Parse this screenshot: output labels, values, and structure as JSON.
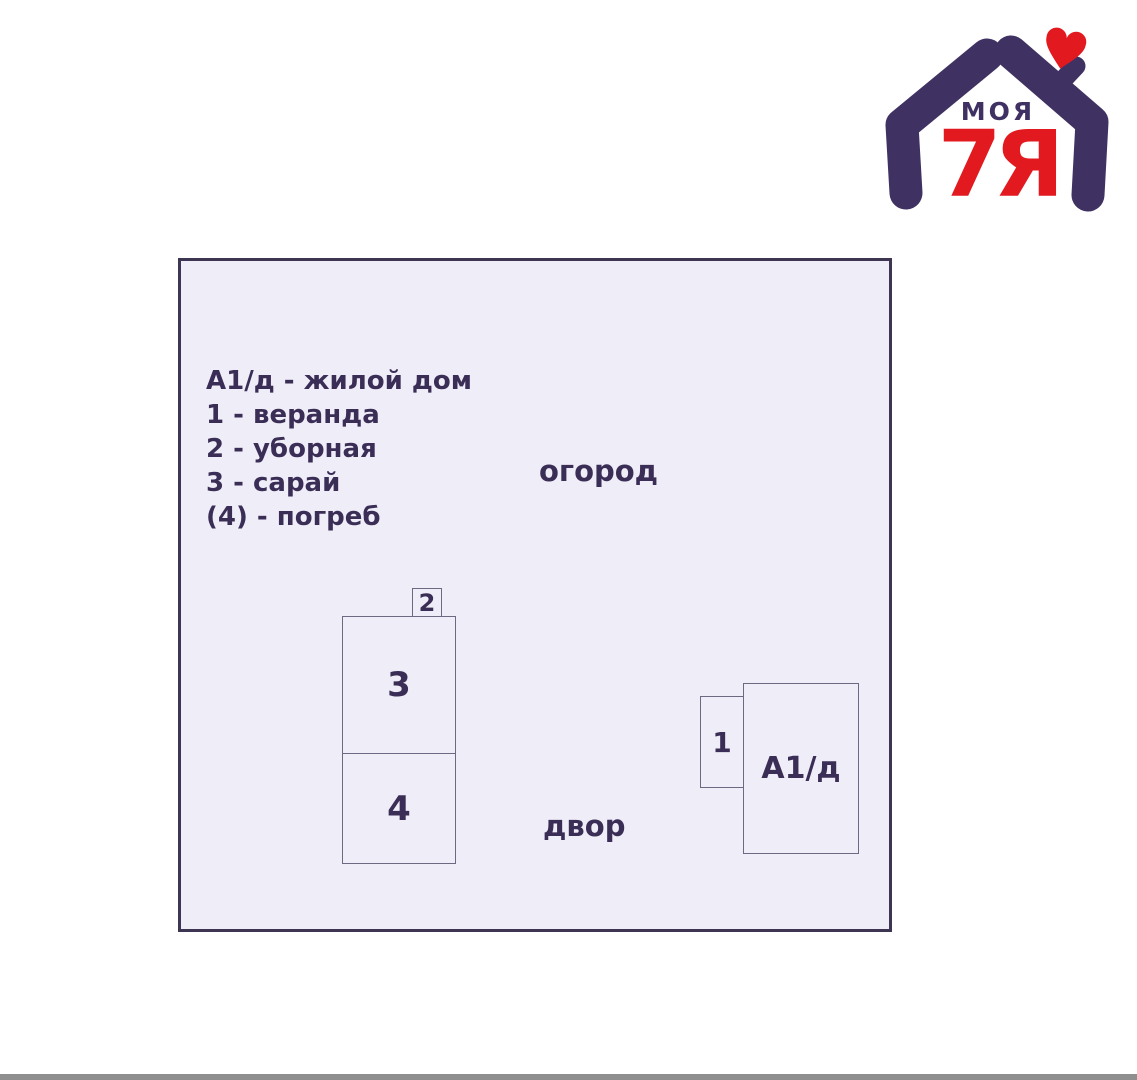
{
  "logo": {
    "brand_top": "МОЯ",
    "brand_bottom": "7Я"
  },
  "plan": {
    "legend": [
      "А1/д - жилой дом",
      "1 - веранда",
      "2 - уборная",
      "3 - сарай",
      "(4) - погреб"
    ],
    "areas": [
      "огород",
      "двор"
    ],
    "buildings": [
      {
        "label": "2"
      },
      {
        "label": "3"
      },
      {
        "label": "4"
      },
      {
        "label": "1"
      },
      {
        "label": "А1/д"
      }
    ]
  },
  "colors": {
    "accent_purple": "#3f3262",
    "logo_red": "#e2191f",
    "plan_bg": "#efedf7",
    "plan_border": "#3d3552",
    "building_border": "#6e6983",
    "text": "#3a2d56",
    "bottom_bar": "#8f8f8f"
  }
}
